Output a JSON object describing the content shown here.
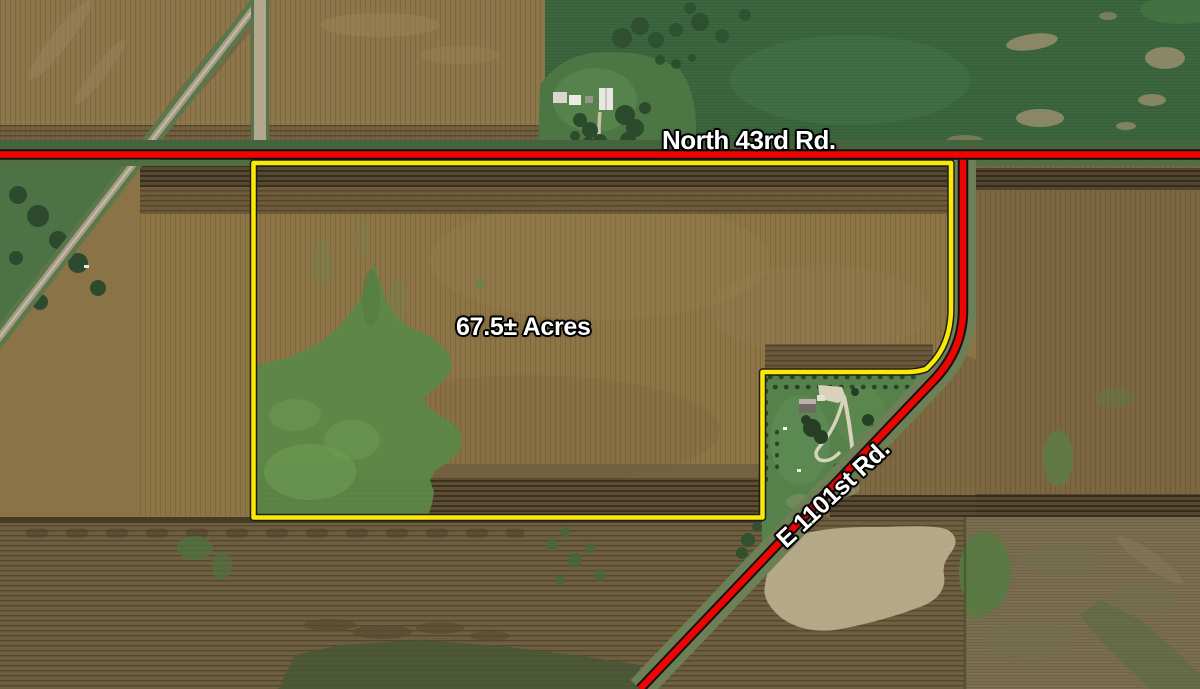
{
  "map": {
    "description": "Aerial farmland parcel map",
    "road_labels": {
      "north": "North 43rd Rd.",
      "east": "E 1101st Rd."
    },
    "parcel": {
      "acreage_label": "67.5± Acres",
      "boundary_color": "#fce903",
      "road_line_color": "#ee0400",
      "label_color": "#ffffff"
    }
  }
}
